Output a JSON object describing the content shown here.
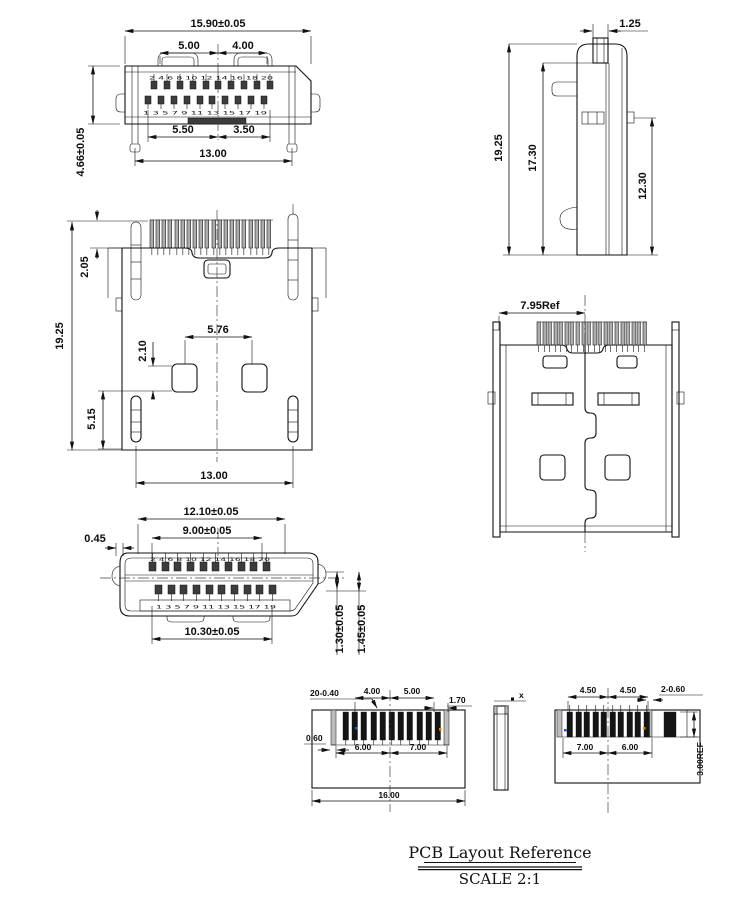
{
  "title": {
    "name": "PCB Layout Reference",
    "scale": "SCALE 2:1"
  },
  "top_view": {
    "overall_width": "15.90±0.05",
    "pitch_left": "5.00",
    "pitch_right": "4.00",
    "row_left": "5.50",
    "row_right": "3.50",
    "leg_span": "13.00",
    "height": "4.66±0.05",
    "pins_even": "2 4 6 8 10 12 14 16 18 20",
    "pins_odd": "1 3 5 7 9 11 13 15 17 19"
  },
  "side_view": {
    "tab_width": "1.25",
    "overall_height": "19.25",
    "body_height": "17.30",
    "lock_height": "12.30"
  },
  "bottom_view": {
    "pin_tip": "2.05",
    "overall_height": "19.25",
    "pad_pitch": "5.76",
    "pad_size": "2.10",
    "leg_height": "5.15",
    "leg_span": "13.00"
  },
  "rear_view": {
    "ref_width": "7.95Ref"
  },
  "front_view": {
    "shell_width": "12.10±0.05",
    "contact_span": "9.00±0.05",
    "shell_offset": "0.45",
    "lower_span": "10.30±0.05",
    "step1": "1.30±0.05",
    "step2": "1.45±0.05",
    "pins_top": "2 4 6 8 10 12 14 16 18 20",
    "pins_bottom": "1 3 5 7 9 11 13 15 17 19"
  },
  "pcb_left": {
    "holes": "20-0.40",
    "a": "4.00",
    "b": "5.00",
    "c": "1.70",
    "slot": "0.60",
    "d": "6.00",
    "e": "7.00",
    "width": "16.00"
  },
  "pcb_side": {
    "thickness": "x"
  },
  "pcb_right": {
    "a": "4.50",
    "b": "4.50",
    "holes": "2-0.60",
    "c": "7.00",
    "d": "6.00",
    "ref": "3.00REF"
  },
  "colors": {
    "line": "#111111",
    "comb_fill": "#adadad",
    "tooth_fill": "#141414",
    "mark_blue": "#2255cc",
    "mark_orange": "#e08a00"
  }
}
